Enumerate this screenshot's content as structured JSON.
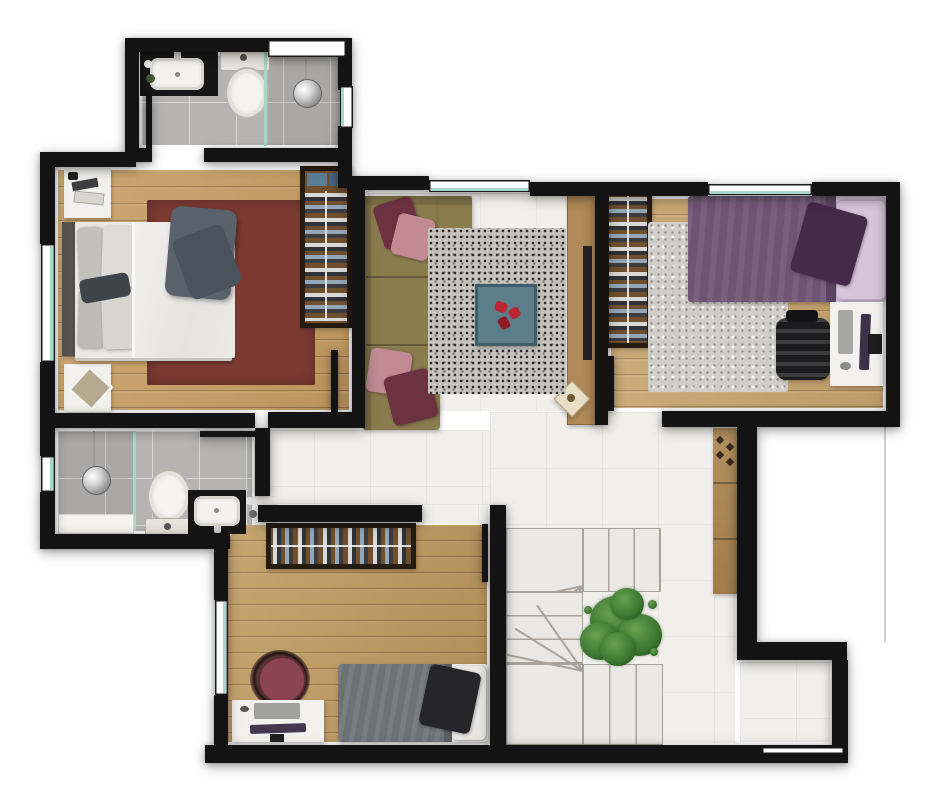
{
  "plan": {
    "type": "residential-floor-plan",
    "view": "top-down-3d-render",
    "rooms": [
      {
        "id": "bathroom-top",
        "label": "Bathroom 1",
        "contents": [
          "black-vanity-with-sink",
          "toilet",
          "walk-in-shower",
          "glass-partition",
          "window-top",
          "window-right",
          "door"
        ]
      },
      {
        "id": "master-bedroom",
        "label": "Bedroom 1 (double)",
        "contents": [
          "double-bed",
          "dark-red-rug",
          "nightstand-top",
          "nightstand-bottom",
          "open-wardrobe-with-clothes",
          "window-left",
          "door"
        ]
      },
      {
        "id": "living-room",
        "label": "Living room",
        "contents": [
          "l-shaped-sofa",
          "throw-pillows",
          "speckled-gray-rug",
          "teal-coffee-table",
          "tv-console",
          "tv",
          "decor-tray",
          "window-top"
        ]
      },
      {
        "id": "bedroom-right",
        "label": "Bedroom 2 (single)",
        "contents": [
          "single-bed-purple",
          "gray-shag-rug",
          "open-wardrobe-with-clothes",
          "desk",
          "keyboard",
          "monitor",
          "mouse",
          "office-chair",
          "window-top",
          "door"
        ]
      },
      {
        "id": "bathroom-left",
        "label": "Bathroom 2",
        "contents": [
          "walk-in-shower",
          "glass-partition",
          "bench",
          "toilet",
          "black-vanity-with-sink",
          "window-left",
          "door"
        ]
      },
      {
        "id": "bedroom-bottom",
        "label": "Bedroom 3 (single)",
        "contents": [
          "single-bed-gray",
          "open-clothes-rack",
          "round-armchair",
          "desk",
          "keyboard",
          "monitor",
          "mouse",
          "window-left",
          "door"
        ]
      },
      {
        "id": "hall",
        "label": "Hall / circulation",
        "contents": [
          "u-shaped-staircase",
          "potted-plant",
          "tall-wood-cabinet",
          "void-open-to-below"
        ]
      }
    ],
    "colors": {
      "wall": "#131313",
      "glass": "#a7d7cb",
      "tile_bath": "#b5b4b2",
      "tile_white": "#f0efec",
      "wood_a": "#c79e63",
      "wood_b": "#c6a26c",
      "wood_c": "#bf9a60",
      "rack_wood": "#6f4f2e",
      "frame_dark": "#251b10",
      "sofa": "#8b7c4e",
      "sofa_dark": "#6f6340",
      "pillow_burgundy": "#6d3242",
      "pillow_pink": "#c28b94",
      "rug_red": "#7c3a33",
      "rug_gray": "#c6c3bd",
      "rug_light": "#d0cec9",
      "teal_table": "#5b7e8a",
      "red_accent": "#bb2430",
      "purple_duvet": "#6f5573",
      "purple_dark": "#452a49",
      "lilac": "#d7c4da",
      "gray_duvet": "#6e7277",
      "black_pillow": "#26262a",
      "wood_furn": "#b08a58",
      "cabinet": "#a9895a",
      "white_furn": "#f2f1ee",
      "counter_black": "#161616",
      "stair_tread": "#eae8e3",
      "stair_line": "#a8a49b",
      "plant_green": "#3f7a33"
    }
  }
}
